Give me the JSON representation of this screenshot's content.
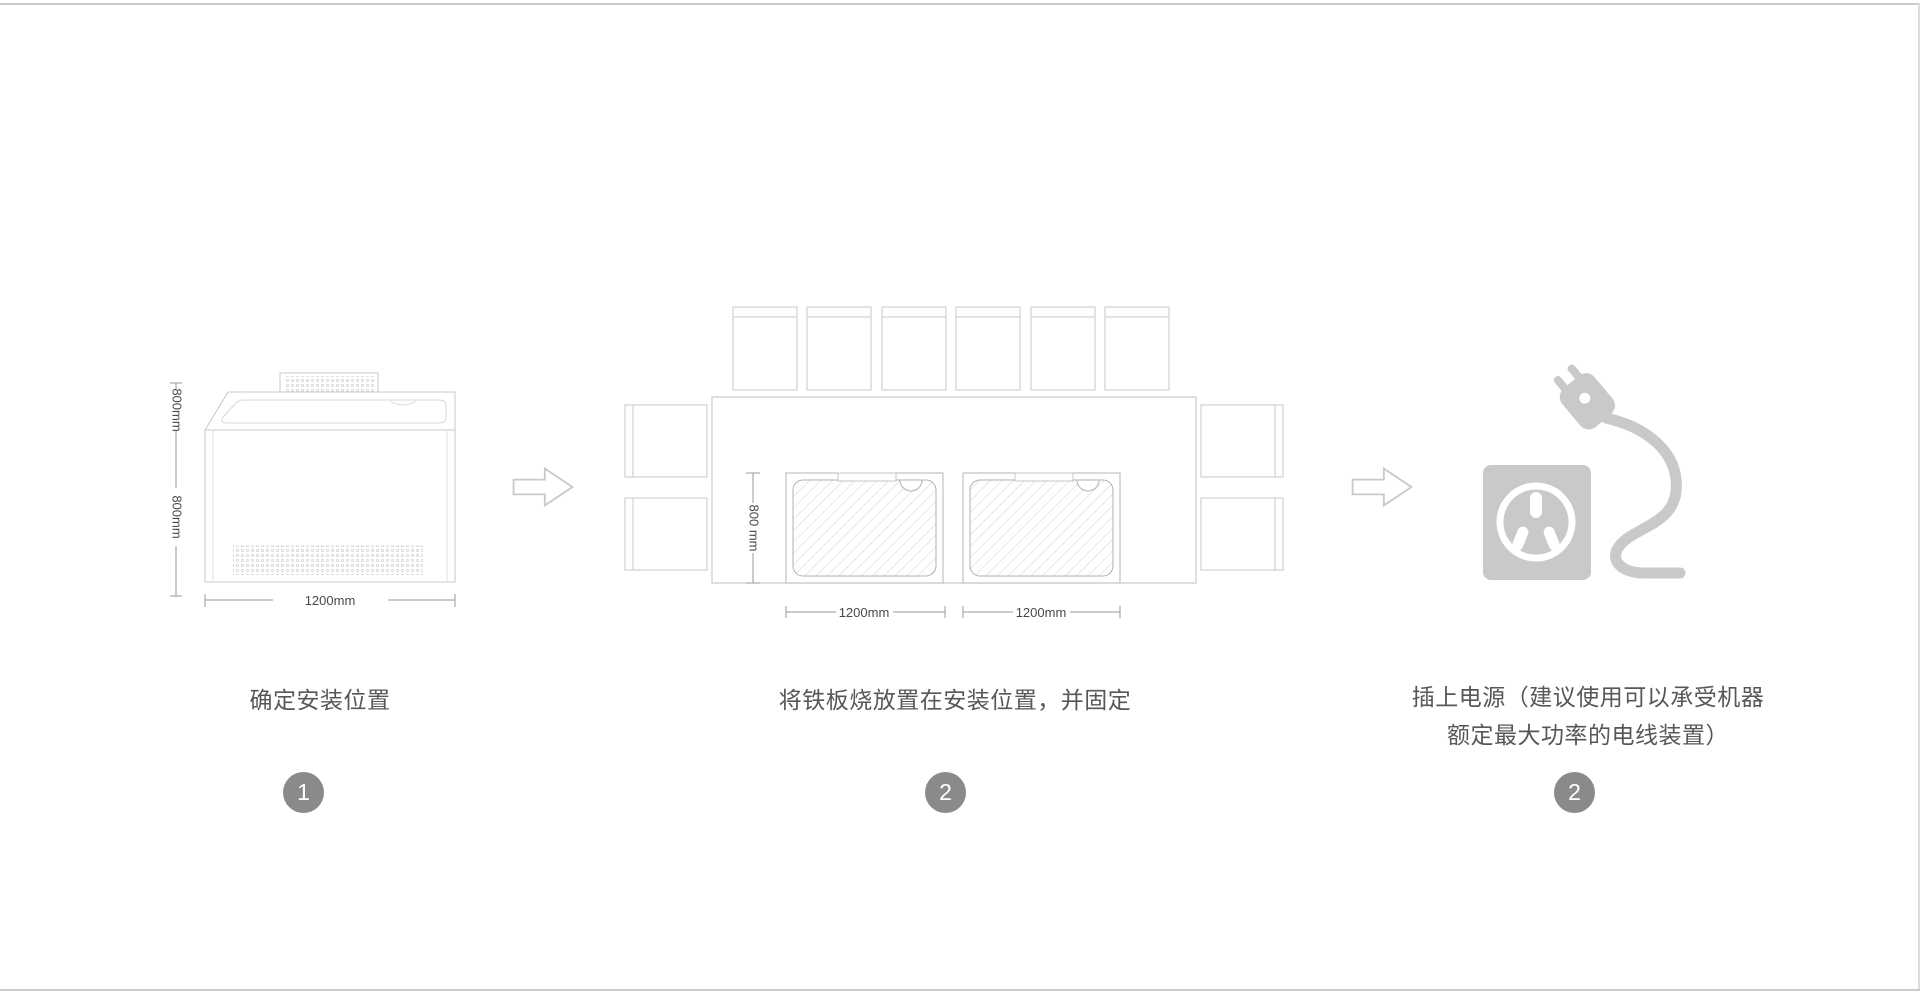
{
  "page": {
    "background": "#ffffff",
    "border_color": "#cccccc"
  },
  "colors": {
    "drawing_stroke": "#c8c8c8",
    "drawing_stroke_light": "#d8d8d8",
    "dimension_stroke": "#9a9a9a",
    "dimension_text": "#484848",
    "caption_text": "#575757",
    "badge_background": "#8a8a8a",
    "badge_text": "#ffffff",
    "icon_gray": "#c9c9c9"
  },
  "steps": [
    {
      "badge": "1",
      "caption": "确定安装位置",
      "figure": "teppanyaki-machine-front-view",
      "dims": {
        "top_height": "800mm",
        "body_height": "800mm",
        "width": "1200mm"
      }
    },
    {
      "badge": "2",
      "caption": "将铁板烧放置在安装位置，并固定",
      "figure": "installation-layout-top-view",
      "dims": {
        "depth": "800 mm",
        "left_width": "1200mm",
        "right_width": "1200mm"
      }
    },
    {
      "badge": "2",
      "caption_line1": "插上电源（建议使用可以承受机器",
      "caption_line2": "额定最大功率的电线装置）",
      "figure": "power-plug-and-socket-icon"
    }
  ]
}
